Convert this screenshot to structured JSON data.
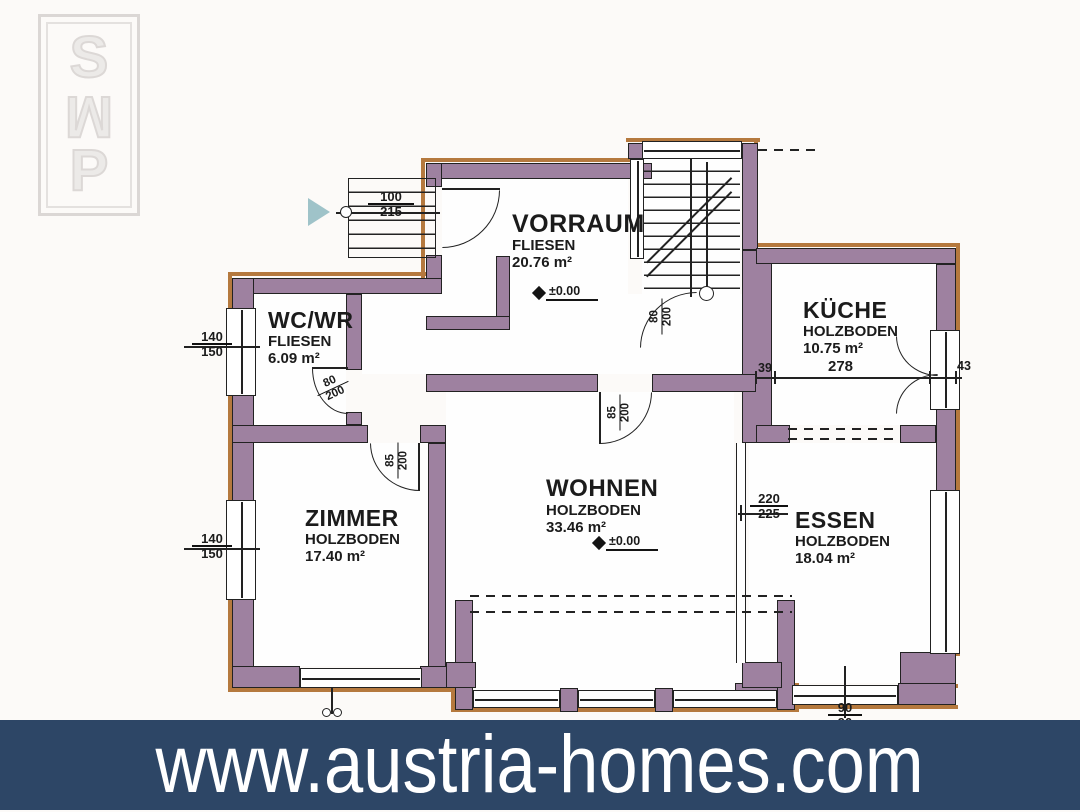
{
  "watermark": {
    "letters": [
      "S",
      "M",
      "P"
    ]
  },
  "banner": {
    "url": "www.austria-homes.com",
    "bg_color": "#2d4666",
    "text_color": "#ffffff"
  },
  "colors": {
    "wall": "#9e81a0",
    "outer_outline": "#b5793e",
    "plan_lines": "#222222",
    "arrow": "#9fc3c9"
  },
  "rooms": {
    "vorraum": {
      "name": "VORRAUM",
      "floor": "FLIESEN",
      "area": "20.76 m²"
    },
    "wcwr": {
      "name": "WC/WR",
      "floor": "FLIESEN",
      "area": "6.09 m²"
    },
    "kueche": {
      "name": "KÜCHE",
      "floor": "HOLZBODEN",
      "area": "10.75 m²"
    },
    "zimmer": {
      "name": "ZIMMER",
      "floor": "HOLZBODEN",
      "area": "17.40 m²"
    },
    "wohnen": {
      "name": "WOHNEN",
      "floor": "HOLZBODEN",
      "area": "33.46 m²"
    },
    "essen": {
      "name": "ESSEN",
      "floor": "HOLZBODEN",
      "area": "18.04 m²"
    }
  },
  "levels": {
    "vorraum": "±0.00",
    "wohnen": "±0.00"
  },
  "dims": {
    "entry_door": {
      "top": "100",
      "bottom": "215"
    },
    "wc_window": {
      "top": "140",
      "bottom": "150"
    },
    "zimmer_window": {
      "top": "140",
      "bottom": "150"
    },
    "wc_door": {
      "top": "80",
      "bottom": "200"
    },
    "stair_door": {
      "top": "80",
      "bottom": "200"
    },
    "zimmer_door": {
      "top": "85",
      "bottom": "200"
    },
    "wohnen_door": {
      "top": "85",
      "bottom": "200"
    },
    "essen_opening": {
      "top": "220",
      "bottom": "225"
    },
    "essen_window": {
      "top": "90",
      "bottom": "90"
    },
    "kueche_offset": "39",
    "kueche_width": "278",
    "kueche_door": "43"
  }
}
